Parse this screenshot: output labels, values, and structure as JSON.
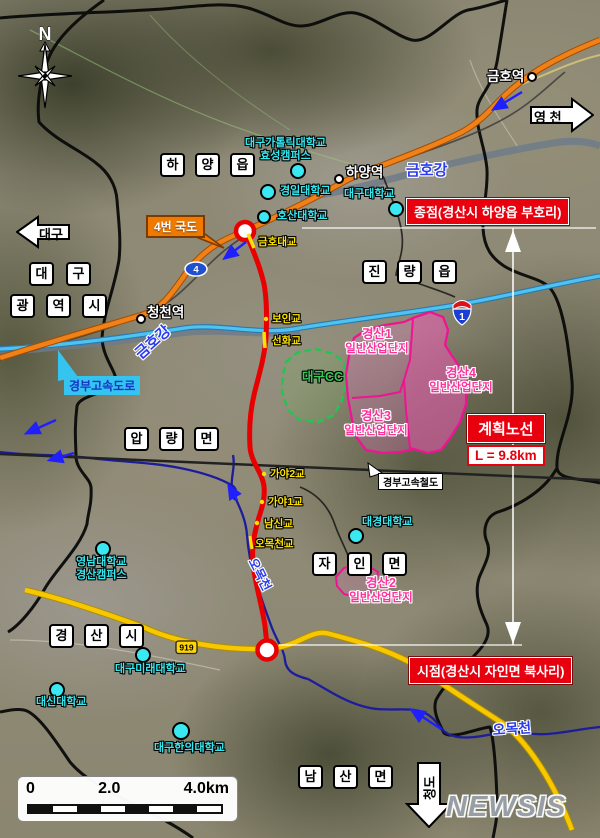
{
  "compass": {
    "label": "N"
  },
  "watermark": {
    "label": "NEWSIS"
  },
  "endpoints": {
    "terminus": "종점(경산시 하양읍 부호리)",
    "origin": "시점(경산시 자인면 북사리)"
  },
  "plan_box": {
    "title": "계획노선",
    "length": "L = 9.8km"
  },
  "direction_arrows": [
    {
      "id": "daegu",
      "label": "대구"
    },
    {
      "id": "yeongcheon",
      "label": "영 천"
    },
    {
      "id": "cheongdo",
      "label": "청도"
    }
  ],
  "districts": [
    {
      "name": "하양읍",
      "chars": [
        "하",
        "양",
        "읍"
      ],
      "x": 160,
      "y": 153,
      "gap": 10
    },
    {
      "name": "대구",
      "chars": [
        "대",
        "구"
      ],
      "x": 29,
      "y": 262,
      "gap": 12
    },
    {
      "name": "광역시",
      "chars": [
        "광",
        "역",
        "시"
      ],
      "x": 10,
      "y": 294,
      "gap": 11
    },
    {
      "name": "진량읍",
      "chars": [
        "진",
        "량",
        "읍"
      ],
      "x": 362,
      "y": 260,
      "gap": 10
    },
    {
      "name": "압량면",
      "chars": [
        "압",
        "량",
        "면"
      ],
      "x": 124,
      "y": 427,
      "gap": 10
    },
    {
      "name": "자인면",
      "chars": [
        "자",
        "인",
        "면"
      ],
      "x": 312,
      "y": 552,
      "gap": 10
    },
    {
      "name": "경산시",
      "chars": [
        "경",
        "산",
        "시"
      ],
      "x": 49,
      "y": 624,
      "gap": 10
    },
    {
      "name": "남산면",
      "chars": [
        "남",
        "산",
        "면"
      ],
      "x": 298,
      "y": 765,
      "gap": 10
    }
  ],
  "universities": [
    {
      "label": "대구가톨릭대학교",
      "label2": "효성캠퍼스",
      "tx": 245,
      "ty": 137,
      "dx": 298,
      "dy": 171,
      "dr": 8,
      "align": "center"
    },
    {
      "label": "경일대학교",
      "tx": 280,
      "ty": 185,
      "dx": 268,
      "dy": 192,
      "dr": 8
    },
    {
      "label": "대구대학교",
      "tx": 344,
      "ty": 188,
      "dx": 396,
      "dy": 209,
      "dr": 8
    },
    {
      "label": "호산대학교",
      "tx": 277,
      "ty": 210,
      "dx": 264,
      "dy": 217,
      "dr": 7
    },
    {
      "label": "영남대학교",
      "label2": "경산캠퍼스",
      "tx": 76,
      "ty": 556,
      "dx": 103,
      "dy": 549,
      "dr": 8,
      "align": "center"
    },
    {
      "label": "대구미래대학교",
      "tx": 115,
      "ty": 663,
      "dx": 143,
      "dy": 655,
      "dr": 8
    },
    {
      "label": "대신대학교",
      "tx": 36,
      "ty": 696,
      "dx": 57,
      "dy": 690,
      "dr": 8
    },
    {
      "label": "대구한의대학교",
      "tx": 154,
      "ty": 742,
      "dx": 181,
      "dy": 731,
      "dr": 9
    },
    {
      "label": "대경대학교",
      "tx": 362,
      "ty": 516,
      "dx": 356,
      "dy": 536,
      "dr": 8
    }
  ],
  "stations": [
    {
      "label": "금호역",
      "tx": 487,
      "ty": 69,
      "dx": 532,
      "dy": 77
    },
    {
      "label": "하양역",
      "tx": 346,
      "ty": 165,
      "dx": 339,
      "dy": 179
    },
    {
      "label": "청천역",
      "tx": 147,
      "ty": 305,
      "dx": 141,
      "dy": 319
    }
  ],
  "bridges": [
    {
      "label": "금호대교",
      "x": 258,
      "y": 236
    },
    {
      "label": "보인교",
      "x": 272,
      "y": 313
    },
    {
      "label": "선화교",
      "x": 272,
      "y": 335
    },
    {
      "label": "가야2교",
      "x": 270,
      "y": 468
    },
    {
      "label": "가야1교",
      "x": 268,
      "y": 496
    },
    {
      "label": "남신교",
      "x": 264,
      "y": 518
    },
    {
      "label": "오목천교",
      "x": 255,
      "y": 538
    }
  ],
  "water_labels": [
    {
      "label": "금호강",
      "x": 406,
      "y": 162,
      "rot": 0,
      "size": 15
    },
    {
      "label": "금호강",
      "x": 132,
      "y": 350,
      "rot": -42,
      "size": 15
    },
    {
      "label": "오목천",
      "x": 258,
      "y": 556,
      "rot": 63,
      "size": 12.5
    },
    {
      "label": "오목천",
      "x": 492,
      "y": 722,
      "rot": -4,
      "size": 14
    }
  ],
  "industrial_sites": [
    {
      "line1": "경산1",
      "line2": "일반산업단지",
      "cx": 377,
      "y": 327
    },
    {
      "line1": "경산4",
      "line2": "일반산업단지",
      "cx": 461,
      "y": 366
    },
    {
      "line1": "경산3",
      "line2": "일반산업단지",
      "cx": 376,
      "y": 409
    },
    {
      "line1": "경산2",
      "line2": "일반산업단지",
      "cx": 381,
      "y": 576
    }
  ],
  "golf": {
    "label": "대구CC",
    "x": 302,
    "y": 370
  },
  "road_labels": {
    "national_route_4": "4번 국도",
    "expressway": "경부고속도로",
    "ktx": "경부고속철도"
  },
  "shields": {
    "national_4": "4",
    "expressway_1": "1",
    "local_919": "919"
  },
  "scale_bar": {
    "ticks": [
      "0",
      "2.0",
      "4.0km"
    ]
  },
  "flow_arrows": [
    {
      "x1": 522,
      "y1": 92,
      "x2": 494,
      "y2": 109
    },
    {
      "x1": 246,
      "y1": 242,
      "x2": 225,
      "y2": 258
    },
    {
      "x1": 56,
      "y1": 420,
      "x2": 27,
      "y2": 433
    },
    {
      "x1": 74,
      "y1": 453,
      "x2": 50,
      "y2": 460
    },
    {
      "x1": 237,
      "y1": 500,
      "x2": 229,
      "y2": 486
    },
    {
      "x1": 441,
      "y1": 729,
      "x2": 412,
      "y2": 710
    }
  ],
  "colors": {
    "route_red": "#e80000",
    "industry_magenta": "#ee1492",
    "poi_cyan": "#35e8f0",
    "road_orange": "#f08018",
    "road_yellow": "#f7c800",
    "expressway_cyan": "#4fc3f0",
    "river_navy": "#1d1d9c"
  }
}
